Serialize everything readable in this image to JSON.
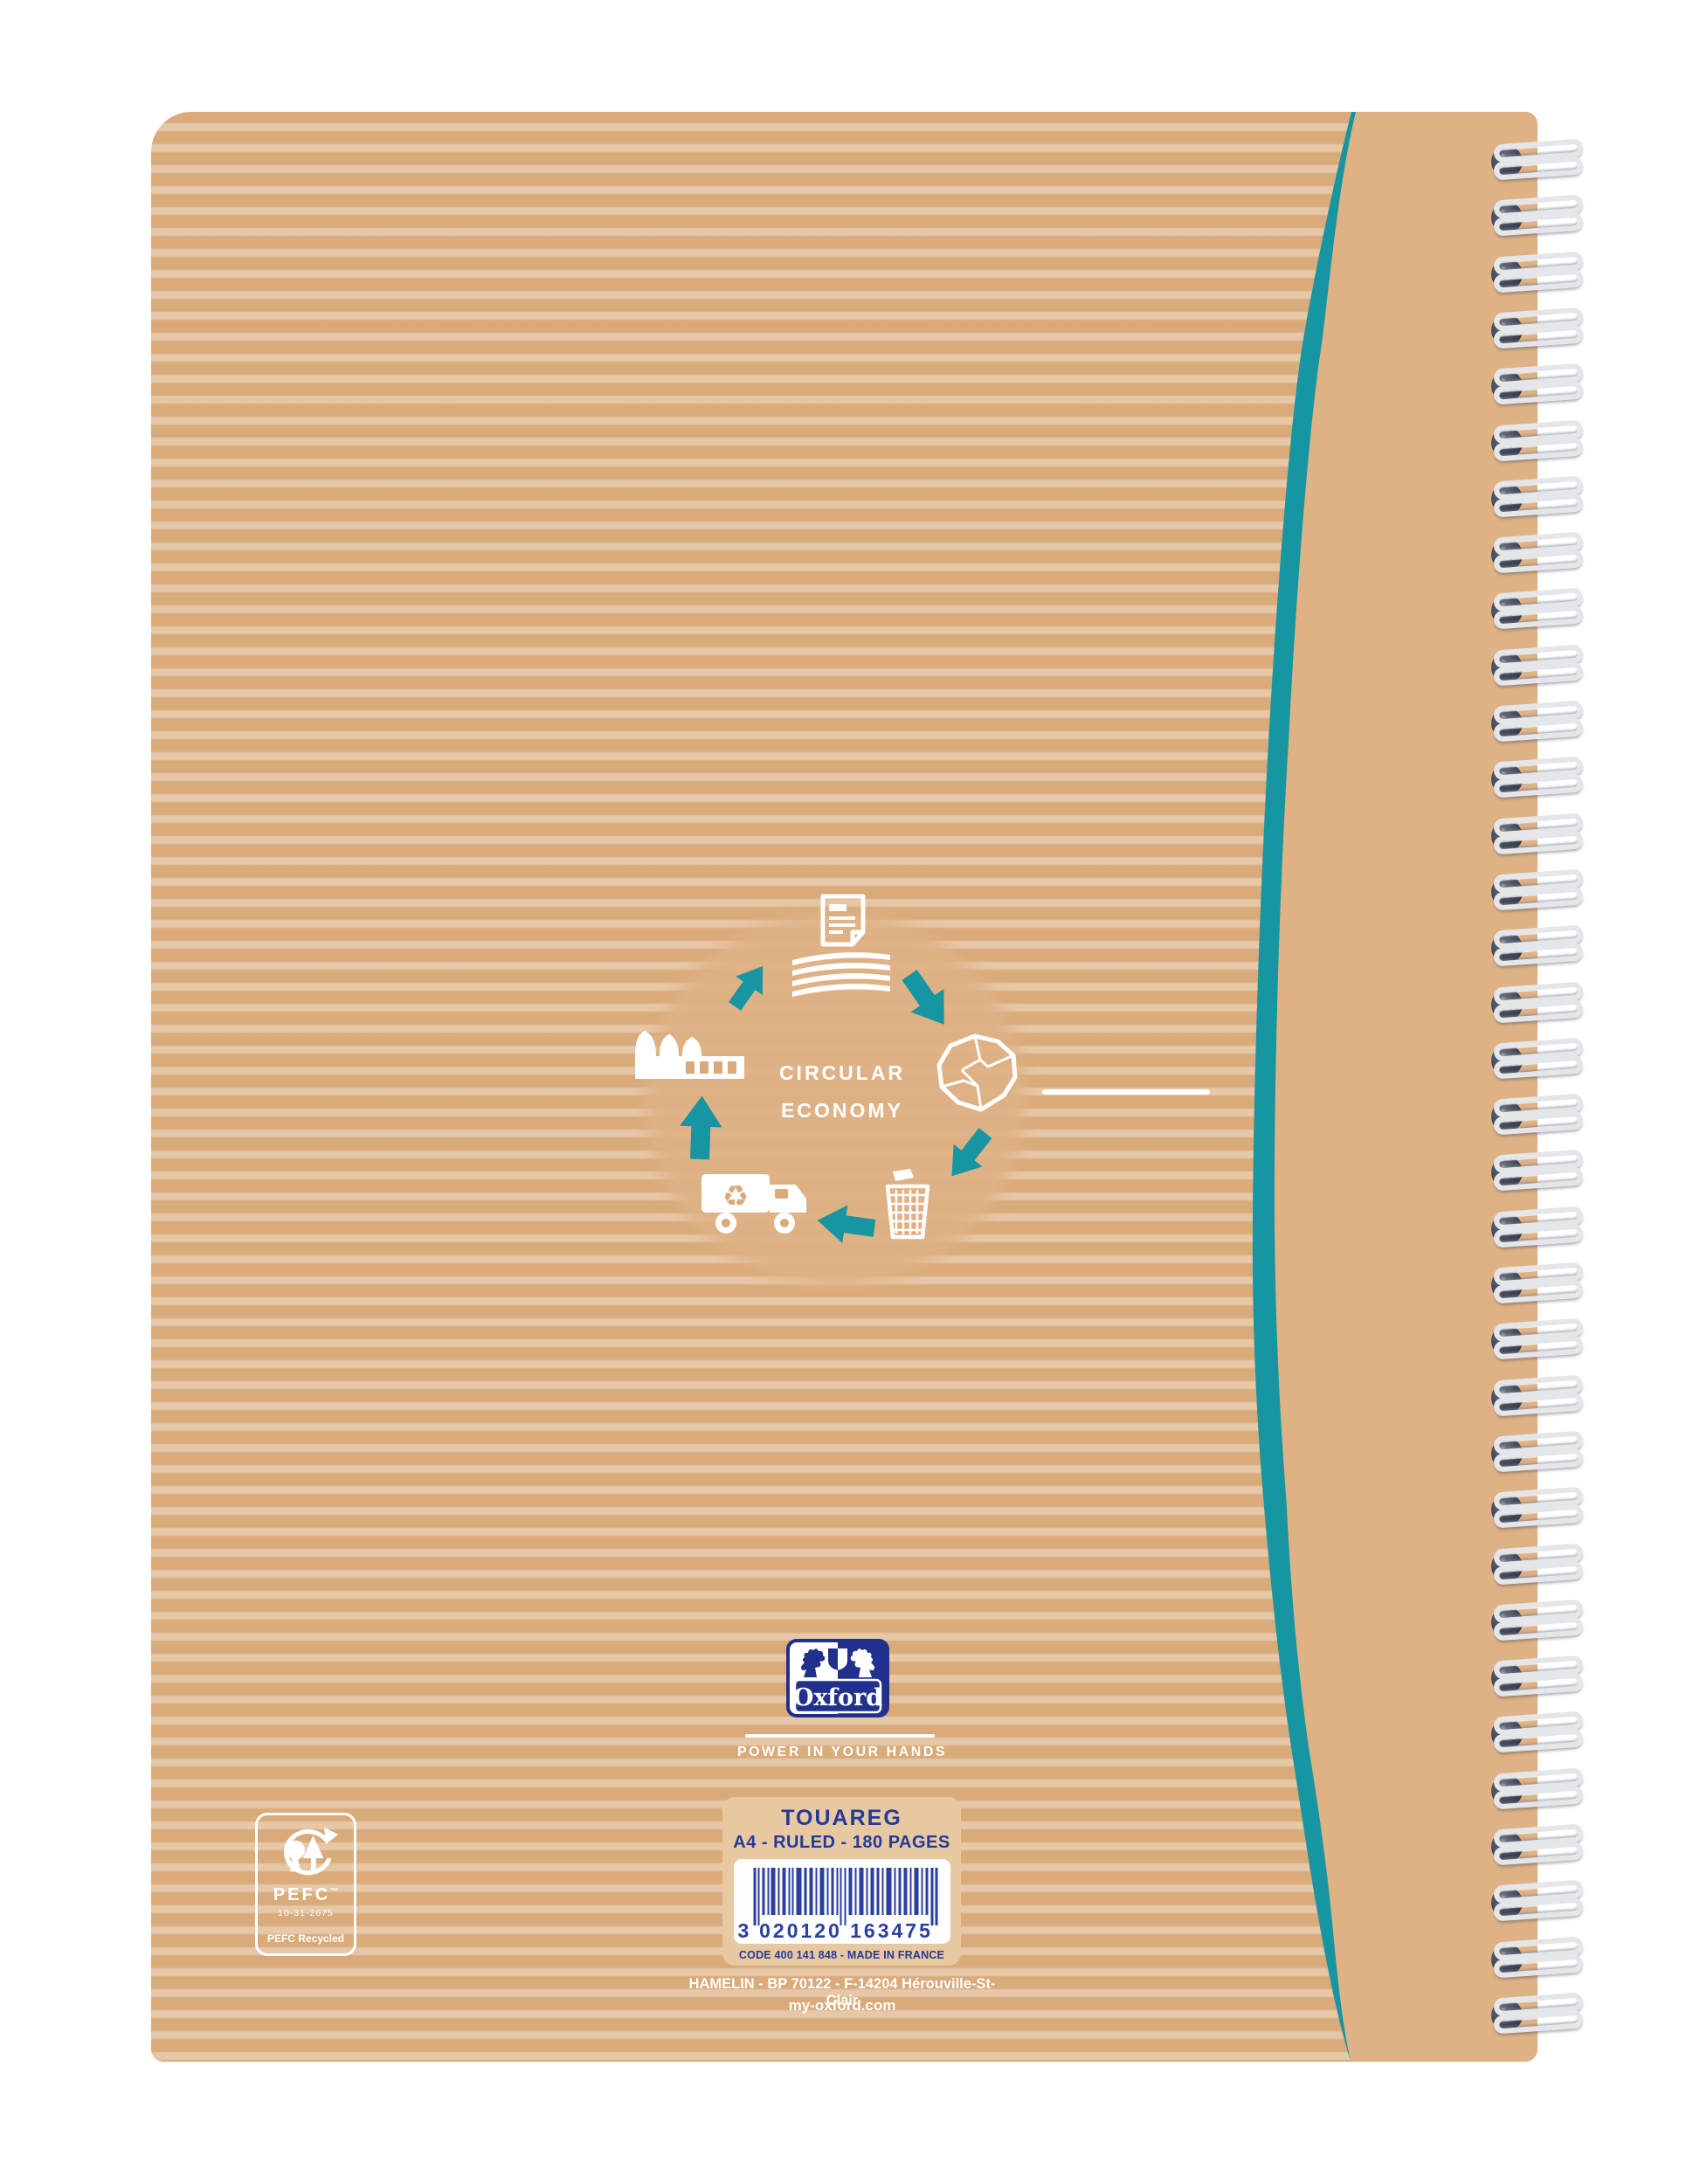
{
  "notebook": {
    "artwork": {
      "line1": "CIRCULAR",
      "line2": "ECONOMY"
    },
    "brand": {
      "name": "Oxford",
      "tagline": "POWER IN YOUR HANDS"
    },
    "label": {
      "name": "TOUAREG",
      "specs": "A4 - RULED - 180 PAGES",
      "barcode": {
        "lead": "3",
        "left": "020120",
        "right": "163475"
      },
      "code_line": "CODE 400 141 848 - MADE IN FRANCE"
    },
    "footer": {
      "manufacturer": "HAMELIN - BP 70122 - F-14204 Hérouville-St-Clair",
      "website": "my-oxford.com"
    },
    "pefc": {
      "name": "PEFC",
      "trademark": "™",
      "license": "10-31-2675",
      "label": "PEFC Recycled"
    }
  },
  "colors": {
    "teal": "#1796a2",
    "oxford_navy": "#20308c",
    "label_blue": "#23399b",
    "barcode_blue": "#2b3f9e",
    "kraft_striped": "#d9aa7a",
    "kraft_plain": "#dfb286",
    "label_background": "#e7c8a0",
    "wire_silver": "#e4e6e9"
  },
  "icons": [
    "document-icon",
    "paper-stack-icon",
    "crumpled-paper-icon",
    "trash-bin-icon",
    "recycling-truck-icon",
    "recycle-symbol-icon",
    "factory-icon",
    "cycle-arrow-icon",
    "oxford-lions-crest",
    "pefc-trees-icon",
    "barcode",
    "wire-binding-rings"
  ]
}
